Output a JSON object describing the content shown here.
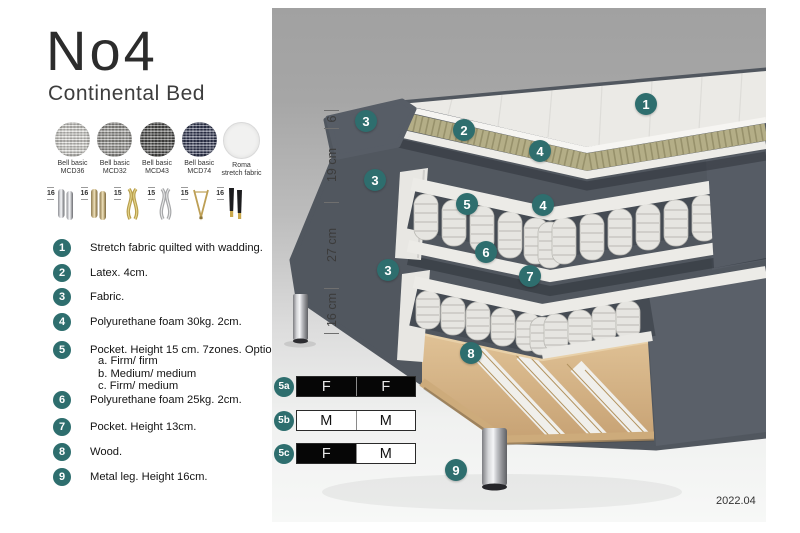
{
  "title": "No4",
  "subtitle": "Continental Bed",
  "version": "2022.04",
  "colors": {
    "accent_teal": "#2e6e6e",
    "fabric_dark": "#51575f",
    "latex_tan": "#b4ae87",
    "wood": "#d4b586",
    "panel_top": "#a1a1a1",
    "panel_bottom": "#f7f8f7"
  },
  "swatches": [
    {
      "line1": "Bell basic",
      "line2": "MCD36",
      "color": "#d8d7d2"
    },
    {
      "line1": "Bell basic",
      "line2": "MCD32",
      "color": "#9b9a96"
    },
    {
      "line1": "Bell basic",
      "line2": "MCD43",
      "color": "#4e4e4c"
    },
    {
      "line1": "Bell basic",
      "line2": "MCD74",
      "color": "#343a57"
    },
    {
      "line1": "Roma",
      "line2": "stretch fabric",
      "color": "#f1f1f0"
    }
  ],
  "legs": [
    {
      "height": "16",
      "type": "cylinder-chrome"
    },
    {
      "height": "16",
      "type": "cylinder-brass"
    },
    {
      "height": "15",
      "type": "twisted-gold"
    },
    {
      "height": "15",
      "type": "twisted-silver"
    },
    {
      "height": "15",
      "type": "hairpin-gold"
    },
    {
      "height": "16",
      "type": "cone-black-gold"
    }
  ],
  "list": {
    "items": [
      {
        "num": "1",
        "text": "Stretch fabric quilted with wadding."
      },
      {
        "num": "2",
        "text": "Latex. 4cm."
      },
      {
        "num": "3",
        "text": "Fabric."
      },
      {
        "num": "4",
        "text": "Polyurethane foam 30kg. 2cm."
      },
      {
        "num": "5",
        "text": "Pocket. Height 15 cm. 7zones. Option:",
        "options": [
          "a. Firm/ firm",
          "b. Medium/ medium",
          "c. Firm/ medium"
        ]
      },
      {
        "num": "6",
        "text": "Polyurethane foam 25kg. 2cm."
      },
      {
        "num": "7",
        "text": "Pocket. Height 13cm."
      },
      {
        "num": "8",
        "text": "Wood."
      },
      {
        "num": "9",
        "text": "Metal leg. Height 16cm."
      }
    ]
  },
  "diagram": {
    "dimensions": [
      "6",
      "19 cm",
      "27 cm",
      "16 cm"
    ],
    "badges": [
      "1",
      "2",
      "3",
      "3",
      "3",
      "4",
      "4",
      "5",
      "6",
      "7",
      "8",
      "9"
    ]
  },
  "firmness": {
    "rows": [
      {
        "label": "5a",
        "cells": [
          {
            "text": "F"
          },
          {
            "text": "F"
          }
        ]
      },
      {
        "label": "5b",
        "cells": [
          {
            "text": "M"
          },
          {
            "text": "M"
          }
        ]
      },
      {
        "label": "5c",
        "cells": [
          {
            "text": "F"
          },
          {
            "text": "M"
          }
        ]
      }
    ]
  }
}
